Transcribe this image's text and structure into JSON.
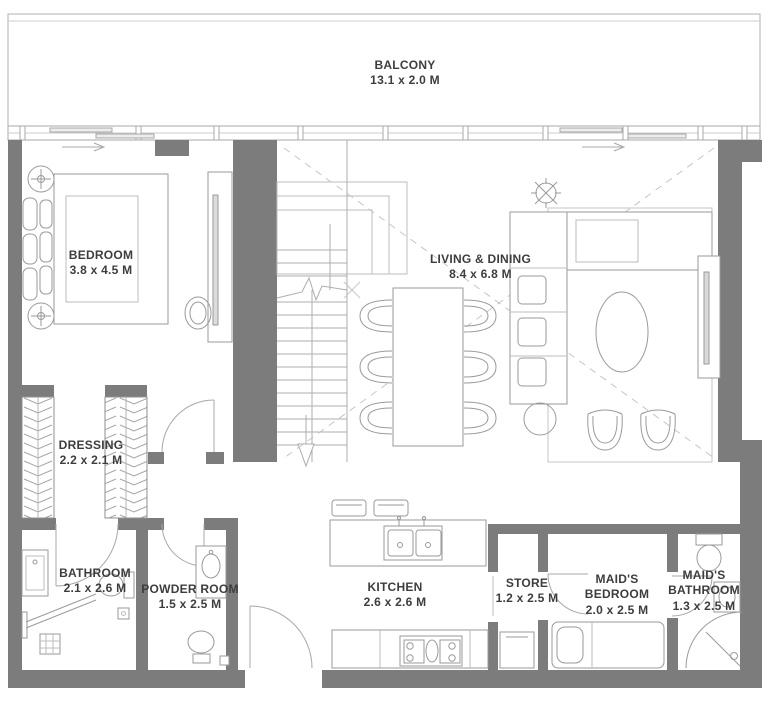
{
  "title": "Apartment floor plan",
  "colors": {
    "wall": "#7c7c7c",
    "line": "#9a9a9a",
    "line_light": "#c2c2c2",
    "text": "#3d3d3d",
    "bg": "#ffffff"
  },
  "rooms": [
    {
      "id": "balcony",
      "name": "BALCONY",
      "dims": "13.1 x 2.0 M"
    },
    {
      "id": "bedroom",
      "name": "BEDROOM",
      "dims": "3.8 x 4.5 M"
    },
    {
      "id": "living_dining",
      "name": "LIVING & DINING",
      "dims": "8.4 x 6.8 M"
    },
    {
      "id": "dressing",
      "name": "DRESSING",
      "dims": "2.2 x 2.1 M"
    },
    {
      "id": "bathroom",
      "name": "BATHROOM",
      "dims": "2.1 x 2.6 M"
    },
    {
      "id": "powder_room",
      "name": "POWDER ROOM",
      "dims": "1.5 x 2.5 M"
    },
    {
      "id": "kitchen",
      "name": "KITCHEN",
      "dims": "2.6 x 2.6 M"
    },
    {
      "id": "store",
      "name": "STORE",
      "dims": "1.2 x 2.5 M"
    },
    {
      "id": "maids_bedroom",
      "name": "MAID'S BEDROOM",
      "dims": "2.0 x 2.5 M"
    },
    {
      "id": "maids_bathroom",
      "name": "MAID'S BATHROOM",
      "dims": "1.3 x 2.5 M"
    }
  ]
}
